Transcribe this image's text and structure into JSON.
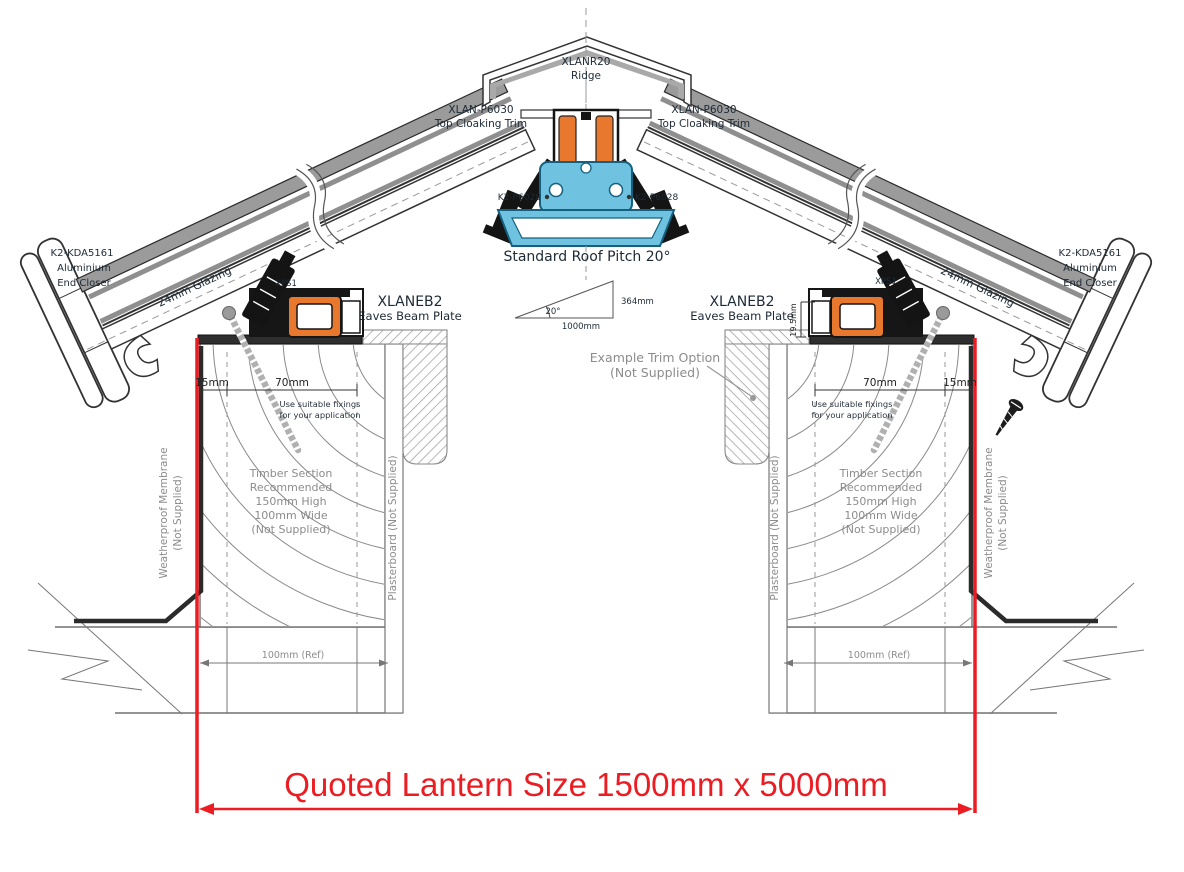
{
  "drawing_title": "Roof lantern cross-section technical drawing",
  "labels": {
    "ridge_code": "XLANR20",
    "ridge_name": "Ridge",
    "top_cloaking_code": "XLAN-P6030",
    "top_cloaking_name": "Top Cloaking Trim",
    "k2_p6028": "K2-P6028",
    "roof_pitch": "Standard Roof Pitch 20°",
    "pitch_angle": "20°",
    "pitch_base": "1000mm",
    "pitch_rise": "364mm",
    "eaves_code": "XLANEB2",
    "eaves_name": "Eaves Beam Plate",
    "xps1": "XPS1",
    "end_closer_code": "K2-KDA5161",
    "end_closer_line2": "Aluminium",
    "end_closer_line3": "End Closer",
    "glazing": "24mm Glazing",
    "dim_15": "15mm",
    "dim_70": "70mm",
    "dim_19_5": "19.5mm",
    "fixings_line1": "Use suitable fixings",
    "fixings_line2": "for your application",
    "trim_option_line1": "Example Trim Option",
    "trim_option_line2": "(Not Supplied)",
    "timber_line1": "Timber Section",
    "timber_line2": "Recommended",
    "timber_line3": "150mm High",
    "timber_line4": "100mm Wide",
    "timber_line5": "(Not Supplied)",
    "membrane_line1": "Weatherproof Membrane",
    "membrane_line2": "(Not Supplied)",
    "plasterboard": "Plasterboard (Not Supplied)",
    "ref_100": "100mm (Ref)",
    "quoted_size": "Quoted Lantern Size 1500mm x 5000mm"
  },
  "colors": {
    "thermal_break_orange": "#e8782e",
    "ridge_profile_blue": "#6fc3e0",
    "ridge_profile_blue_stroke": "#14607e",
    "quoted_dimension_red": "#ec1c23",
    "profile_black": "#141414",
    "glazing_grey": "#8f8f8f",
    "annotation_grey": "#8c8c8c",
    "line_grey": "#555555"
  }
}
